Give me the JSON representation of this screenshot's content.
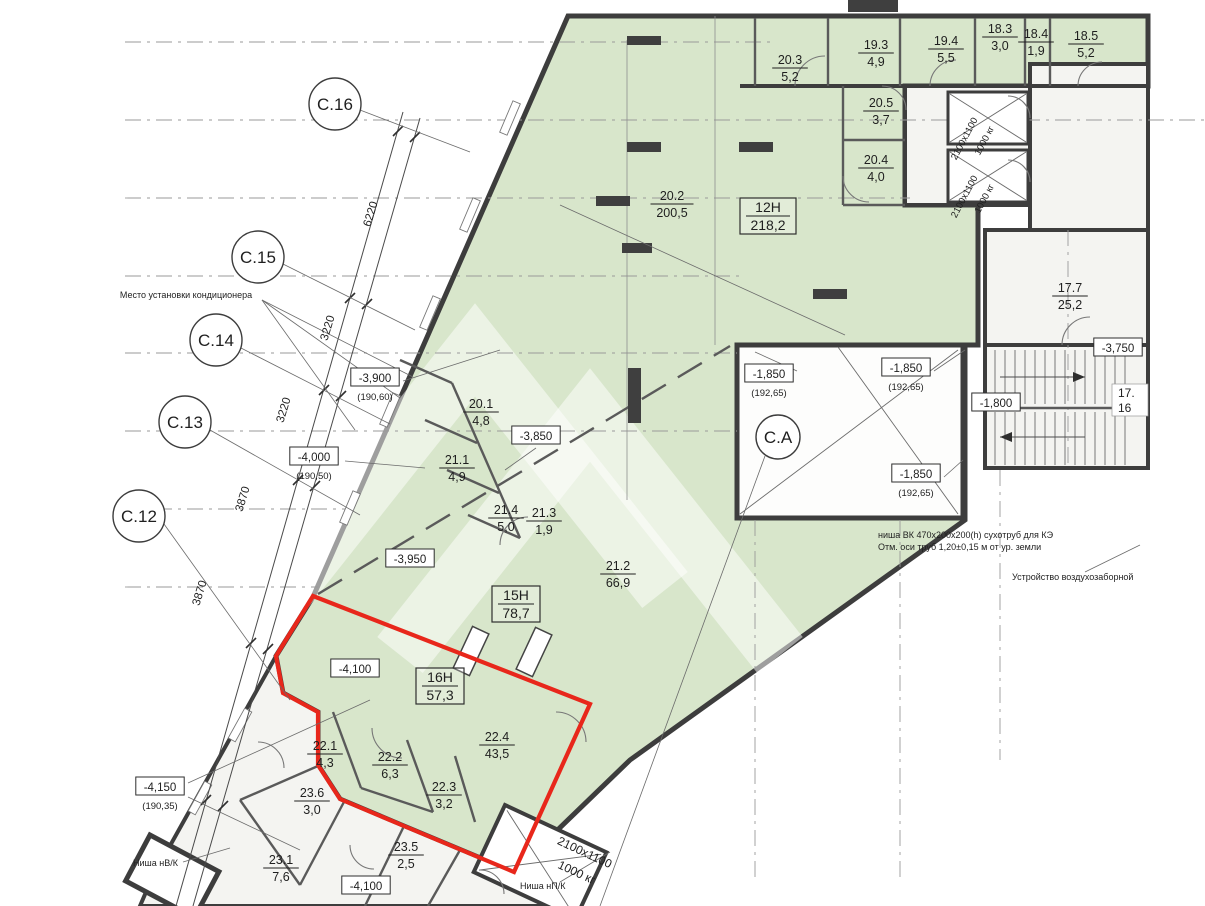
{
  "title": "Floor plan fragment — commercial units, basement level",
  "colors": {
    "room_green": "#d8e6cb",
    "white_room": "#f4f4f1",
    "wall_dark": "#3d3d3d",
    "highlight_red": "#e8271b",
    "text": "#1f1f1f",
    "watermark": "rgba(255,255,255,0.5)"
  },
  "axis_bubbles": [
    {
      "label": "С.16",
      "x": 335,
      "y": 104
    },
    {
      "label": "С.15",
      "x": 258,
      "y": 257
    },
    {
      "label": "С.14",
      "x": 216,
      "y": 340
    },
    {
      "label": "С.13",
      "x": 185,
      "y": 422
    },
    {
      "label": "С.12",
      "x": 139,
      "y": 516
    },
    {
      "label": "С.А",
      "x": 778,
      "y": 437
    }
  ],
  "dimension_chain": [
    {
      "value": "6220",
      "x": 374,
      "y": 215,
      "angle": -73
    },
    {
      "value": "3220",
      "x": 331,
      "y": 329,
      "angle": -73
    },
    {
      "value": "3220",
      "x": 287,
      "y": 411,
      "angle": -73
    },
    {
      "value": "3870",
      "x": 246,
      "y": 500,
      "angle": -73
    },
    {
      "value": "3870",
      "x": 203,
      "y": 594,
      "angle": -73
    }
  ],
  "units": [
    {
      "label": "12Н",
      "area": "218,2",
      "x": 768,
      "y": 212
    },
    {
      "label": "15Н",
      "area": "78,7",
      "x": 516,
      "y": 600
    },
    {
      "label": "16Н",
      "area": "57,3",
      "x": 440,
      "y": 682
    }
  ],
  "rooms": [
    {
      "num": "20.3",
      "area": "5,2",
      "x": 790,
      "y": 64
    },
    {
      "num": "19.3",
      "area": "4,9",
      "x": 876,
      "y": 49
    },
    {
      "num": "19.4",
      "area": "5,5",
      "x": 946,
      "y": 45
    },
    {
      "num": "18.3",
      "area": "3,0",
      "x": 1000,
      "y": 33
    },
    {
      "num": "18.4",
      "area": "1,9",
      "x": 1036,
      "y": 38
    },
    {
      "num": "18.5",
      "area": "5,2",
      "x": 1086,
      "y": 40
    },
    {
      "num": "20.5",
      "area": "3,7",
      "x": 881,
      "y": 107
    },
    {
      "num": "20.4",
      "area": "4,0",
      "x": 876,
      "y": 164
    },
    {
      "num": "20.2",
      "area": "200,5",
      "x": 672,
      "y": 200
    },
    {
      "num": "17.7",
      "area": "25,2",
      "x": 1070,
      "y": 292
    },
    {
      "num": "20.1",
      "area": "4,8",
      "x": 481,
      "y": 408
    },
    {
      "num": "21.1",
      "area": "4,9",
      "x": 457,
      "y": 464
    },
    {
      "num": "21.4",
      "area": "5,0",
      "x": 506,
      "y": 514
    },
    {
      "num": "21.3",
      "area": "1,9",
      "x": 544,
      "y": 517
    },
    {
      "num": "21.2",
      "area": "66,9",
      "x": 618,
      "y": 570
    },
    {
      "num": "22.1",
      "area": "4,3",
      "x": 325,
      "y": 750
    },
    {
      "num": "22.2",
      "area": "6,3",
      "x": 390,
      "y": 761
    },
    {
      "num": "22.3",
      "area": "3,2",
      "x": 444,
      "y": 791
    },
    {
      "num": "22.4",
      "area": "43,5",
      "x": 497,
      "y": 741
    },
    {
      "num": "23.6",
      "area": "3,0",
      "x": 312,
      "y": 797
    },
    {
      "num": "23.1",
      "area": "7,6",
      "x": 281,
      "y": 864
    },
    {
      "num": "23.5",
      "area": "2,5",
      "x": 406,
      "y": 851
    }
  ],
  "elevation_marks": [
    {
      "value": "-3,900",
      "sub": "(190,60)",
      "x": 375,
      "y": 381
    },
    {
      "value": "-4,000",
      "sub": "(190,50)",
      "x": 314,
      "y": 460
    },
    {
      "value": "-3,950",
      "sub": "",
      "x": 410,
      "y": 562
    },
    {
      "value": "-4,100",
      "sub": "",
      "x": 355,
      "y": 672
    },
    {
      "value": "-3,850",
      "sub": "",
      "x": 536,
      "y": 439
    },
    {
      "value": "-1,850",
      "sub": "(192,65)",
      "x": 769,
      "y": 377
    },
    {
      "value": "-1,850",
      "sub": "(192,65)",
      "x": 906,
      "y": 371
    },
    {
      "value": "-1,850",
      "sub": "(192,65)",
      "x": 916,
      "y": 477
    },
    {
      "value": "-1,800",
      "sub": "",
      "x": 996,
      "y": 406
    },
    {
      "value": "-3,750",
      "sub": "",
      "x": 1118,
      "y": 351
    },
    {
      "value": "-4,150",
      "sub": "(190,35)",
      "x": 160,
      "y": 790
    },
    {
      "value": "-4,100",
      "sub": "",
      "x": 366,
      "y": 889
    }
  ],
  "elevator": {
    "size": "2100x1100",
    "capacity": "1000 кг"
  },
  "stairs": {
    "labels": [
      "17.",
      "16"
    ]
  },
  "notes": [
    {
      "text": "Место установки кондиционера",
      "x": 186,
      "y": 298,
      "anchor": "middle"
    },
    {
      "text": "ниша ВК 470х200х200(h) сухотруб для КЭ",
      "x": 878,
      "y": 538,
      "anchor": "start"
    },
    {
      "text": "Отм. оси труб 1,20±0,15 м от ур. земли",
      "x": 878,
      "y": 550,
      "anchor": "start"
    },
    {
      "text": "Устройство воздухозаборной",
      "x": 1012,
      "y": 580,
      "anchor": "start"
    },
    {
      "text": "Ниша нВ/К",
      "x": 133,
      "y": 866,
      "anchor": "start"
    },
    {
      "text": "Ниша нП/К",
      "x": 520,
      "y": 889,
      "anchor": "start"
    }
  ]
}
